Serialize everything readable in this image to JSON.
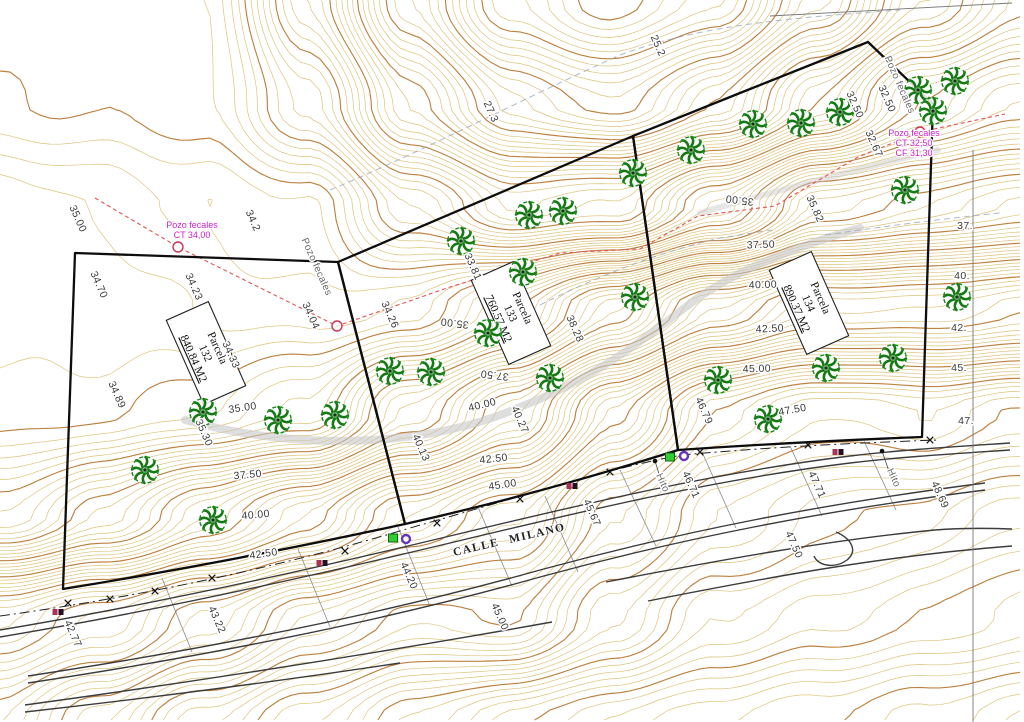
{
  "meta": {
    "width": 1024,
    "height": 722,
    "background": "#ffffff",
    "drawing_type": "topographic parcel plan"
  },
  "colors": {
    "contour": "#d9bc6d",
    "contour_index": "#b97a35",
    "parcel_line": "#0d0d0d",
    "road_line": "#3c3c3c",
    "minor_line": "#8a8a8a",
    "tree_green": "#157a15",
    "tree_ring": "#1d8a1d",
    "magenta": "#cc22cc",
    "sewer_red": "#e05555",
    "drain_gray": "#9aa7bb",
    "track_gray": "#c8c8c8",
    "marker_green": "#33cc33",
    "marker_purple": "#6633bb",
    "marker_red": "#aa3355"
  },
  "street": {
    "label": "CALLE MILANO",
    "x": 510,
    "y": 543,
    "rot": -13
  },
  "parcels": [
    {
      "title": "Parcela",
      "number": "132",
      "area": "840.84 M2",
      "x": 206,
      "y": 353,
      "rot": 66,
      "outline": "M 75,253 L 338,262 L 405,524 Q 230,562 63,589 Z"
    },
    {
      "title": "Parcela",
      "number": "133",
      "area": "760.57 M2",
      "x": 511,
      "y": 313,
      "rot": 66,
      "outline": "M 338,262 L 633,136 L 678,450 Q 535,495 405,524 Z"
    },
    {
      "title": "Parcela",
      "number": "134",
      "area": "890.37 M2",
      "x": 809,
      "y": 303,
      "rot": 66,
      "outline": "M 633,136 L 740,93 L 868,42 L 933,104 L 922,437 Q 795,442 678,450 Z"
    }
  ],
  "labels": [
    {
      "t": "35.00",
      "x": 75,
      "y": 220,
      "r": 66
    },
    {
      "t": "34.2",
      "x": 250,
      "y": 222,
      "r": 66
    },
    {
      "t": "34.70",
      "x": 96,
      "y": 286,
      "r": 66
    },
    {
      "t": "34.23",
      "x": 191,
      "y": 288,
      "r": 66
    },
    {
      "t": "34.04",
      "x": 308,
      "y": 317,
      "r": 66
    },
    {
      "t": "34.26",
      "x": 387,
      "y": 316,
      "r": 66
    },
    {
      "t": "34.33",
      "x": 228,
      "y": 356,
      "r": 66
    },
    {
      "t": "34.89",
      "x": 114,
      "y": 396,
      "r": 66
    },
    {
      "t": "35.30",
      "x": 201,
      "y": 434,
      "r": 66
    },
    {
      "t": "33.81",
      "x": 470,
      "y": 268,
      "r": 66
    },
    {
      "t": "38.28",
      "x": 572,
      "y": 330,
      "r": 66
    },
    {
      "t": "35.82",
      "x": 812,
      "y": 210,
      "r": 66
    },
    {
      "t": "32.50",
      "x": 852,
      "y": 106,
      "r": 66
    },
    {
      "t": "32.50",
      "x": 884,
      "y": 100,
      "r": 66
    },
    {
      "t": "32.67",
      "x": 871,
      "y": 145,
      "r": 66
    },
    {
      "t": "25.2",
      "x": 655,
      "y": 47,
      "r": 66
    },
    {
      "t": "27.3",
      "x": 488,
      "y": 113,
      "r": 66
    },
    {
      "t": "40.13",
      "x": 418,
      "y": 449,
      "r": 66
    },
    {
      "t": "40.27",
      "x": 517,
      "y": 421,
      "r": 66
    },
    {
      "t": "42.77",
      "x": 70,
      "y": 635,
      "r": 66
    },
    {
      "t": "43.22",
      "x": 214,
      "y": 621,
      "r": 66
    },
    {
      "t": "44.20",
      "x": 406,
      "y": 577,
      "r": 66
    },
    {
      "t": "45.67",
      "x": 589,
      "y": 514,
      "r": 66
    },
    {
      "t": "45.00",
      "x": 497,
      "y": 618,
      "r": 66
    },
    {
      "t": "46.79",
      "x": 701,
      "y": 412,
      "r": 66
    },
    {
      "t": "46.71",
      "x": 688,
      "y": 486,
      "r": 66
    },
    {
      "t": "47.71",
      "x": 814,
      "y": 486,
      "r": 66
    },
    {
      "t": "47.50",
      "x": 791,
      "y": 546,
      "r": 66
    },
    {
      "t": "48.69",
      "x": 937,
      "y": 496,
      "r": 66
    },
    {
      "t": "35.00",
      "x": 243,
      "y": 411,
      "r": -8
    },
    {
      "t": "37.50",
      "x": 248,
      "y": 478,
      "r": -5
    },
    {
      "t": "40.00",
      "x": 256,
      "y": 518,
      "r": -5
    },
    {
      "t": "42.50",
      "x": 264,
      "y": 557,
      "r": -8
    },
    {
      "t": "35.00",
      "x": 455,
      "y": 320,
      "r": 187
    },
    {
      "t": "37.50",
      "x": 495,
      "y": 372,
      "r": 187
    },
    {
      "t": "35.00",
      "x": 740,
      "y": 197,
      "r": 187
    },
    {
      "t": "40.00",
      "x": 483,
      "y": 408,
      "r": -14
    },
    {
      "t": "42.50",
      "x": 494,
      "y": 462,
      "r": -6
    },
    {
      "t": "45.00",
      "x": 503,
      "y": 488,
      "r": -8
    },
    {
      "t": "37.50",
      "x": 761,
      "y": 248,
      "r": -2
    },
    {
      "t": "40.00",
      "x": 763,
      "y": 288,
      "r": -2
    },
    {
      "t": "42.50",
      "x": 770,
      "y": 332,
      "r": -3
    },
    {
      "t": "45.00",
      "x": 757,
      "y": 372,
      "r": -2
    },
    {
      "t": "47.50",
      "x": 793,
      "y": 413,
      "r": -10
    },
    {
      "t": "37.",
      "x": 965,
      "y": 229,
      "r": 0
    },
    {
      "t": "40.",
      "x": 962,
      "y": 279,
      "r": 0
    },
    {
      "t": "42.",
      "x": 959,
      "y": 331,
      "r": 0
    },
    {
      "t": "45.",
      "x": 959,
      "y": 371,
      "r": 0
    },
    {
      "t": "47.",
      "x": 966,
      "y": 424,
      "r": 0
    },
    {
      "t": "Pozo fecales",
      "x": 314,
      "y": 268,
      "r": 66,
      "c": "gray"
    },
    {
      "t": "Pozo fecales",
      "x": 897,
      "y": 86,
      "r": 66,
      "c": "gray"
    },
    {
      "t": "Hito",
      "x": 660,
      "y": 484,
      "r": 66,
      "c": "gray"
    },
    {
      "t": "Hito",
      "x": 891,
      "y": 479,
      "r": 66,
      "c": "gray"
    }
  ],
  "wells": {
    "notes": [
      {
        "lines": [
          "Pozo fecales",
          "CT 34,00"
        ],
        "x": 192,
        "y": 228
      },
      {
        "lines": [
          "Pozo fecales",
          "CT 32,50",
          "CF 31,30"
        ],
        "x": 914,
        "y": 136
      }
    ],
    "shafts": [
      [
        178,
        247
      ],
      [
        337,
        326
      ],
      [
        920,
        132
      ]
    ]
  },
  "trees": [
    [
      203,
      412
    ],
    [
      278,
      420
    ],
    [
      335,
      415
    ],
    [
      145,
      470
    ],
    [
      213,
      520
    ],
    [
      390,
      371
    ],
    [
      431,
      372
    ],
    [
      461,
      241
    ],
    [
      529,
      215
    ],
    [
      563,
      211
    ],
    [
      523,
      272
    ],
    [
      488,
      333
    ],
    [
      550,
      378
    ],
    [
      635,
      297
    ],
    [
      633,
      173
    ],
    [
      691,
      150
    ],
    [
      753,
      124
    ],
    [
      801,
      123
    ],
    [
      840,
      112
    ],
    [
      918,
      90
    ],
    [
      955,
      81
    ],
    [
      933,
      111
    ],
    [
      718,
      380
    ],
    [
      768,
      419
    ],
    [
      826,
      368
    ],
    [
      893,
      358
    ],
    [
      957,
      297
    ],
    [
      905,
      190
    ]
  ],
  "markers": {
    "green_squares": [
      [
        393,
        538
      ],
      [
        670,
        457
      ]
    ],
    "purple_rings": [
      [
        406,
        539
      ],
      [
        684,
        456
      ]
    ],
    "red_pairs": [
      [
        58,
        612
      ],
      [
        322,
        563
      ],
      [
        572,
        486
      ],
      [
        838,
        452
      ]
    ],
    "black_dots": [
      [
        882,
        451
      ],
      [
        655,
        461
      ]
    ],
    "leaders": [
      [
        882,
        451,
        891,
        477
      ],
      [
        655,
        461,
        660,
        477
      ]
    ]
  },
  "road": {
    "fence": "M 0,616 C 130,598 270,570 410,528 C 530,494 610,468 682,455 C 770,447 855,443 938,440",
    "fence_x": [
      [
        68,
        603
      ],
      [
        110,
        599
      ],
      [
        155,
        591
      ],
      [
        212,
        578
      ],
      [
        345,
        551
      ],
      [
        437,
        523
      ],
      [
        520,
        499
      ],
      [
        610,
        472
      ],
      [
        700,
        452
      ],
      [
        808,
        445
      ],
      [
        930,
        440
      ]
    ],
    "edges": [
      "M 0,630 C 150,605 300,572 450,536 C 600,500 720,472 850,456 C 900,450 950,447 1010,443",
      "M 0,637 C 150,612 300,579 450,543 C 600,507 720,479 850,463 C 900,457 950,454 1010,450",
      "M 28,676 C 200,650 380,615 540,570 C 680,532 820,504 985,483",
      "M 28,683 C 200,657 380,622 540,577 C 680,539 820,511 985,490",
      "M 25,705 C 200,681 390,651 552,622",
      "M 25,712 C 150,698 280,681 400,663",
      "M 606,582 C 720,560 830,540 935,530 C 960,528 985,528 1012,529",
      "M 648,601 C 760,579 880,556 1012,546",
      "M 836,532 C 852,539 858,551 847,560 C 835,569 818,566 814,556"
    ],
    "crossings": [
      [
        162,
        578,
        192,
        652
      ],
      [
        298,
        549,
        330,
        627
      ],
      [
        398,
        527,
        430,
        606
      ],
      [
        478,
        507,
        512,
        586
      ],
      [
        545,
        496,
        578,
        572
      ],
      [
        620,
        470,
        656,
        546
      ],
      [
        702,
        452,
        736,
        528
      ],
      [
        790,
        446,
        822,
        516
      ],
      [
        864,
        441,
        896,
        510
      ]
    ],
    "border_lines": [
      "M 770,16 L 1012,3",
      "M 973,150 L 973,722"
    ]
  },
  "utilities": {
    "sewer_red_dashed": [
      [
        95,
        198
      ],
      [
        178,
        247
      ],
      [
        337,
        326
      ],
      [
        450,
        287
      ],
      [
        560,
        253
      ],
      [
        640,
        249
      ],
      [
        698,
        216
      ],
      [
        775,
        206
      ],
      [
        858,
        157
      ],
      [
        920,
        132
      ],
      [
        1005,
        114
      ]
    ],
    "drain_gray_dashed": [
      "M 330,190 C 430,148 520,100 620,55 C 700,25 790,18 900,10",
      "M 540,305 C 600,275 660,252 720,238 L 772,230",
      "M 825,235 C 880,227 940,219 1000,213"
    ],
    "track_bands": [
      "M 185,420 C 300,452 430,447 520,407 C 600,377 655,330 695,300 C 735,272 790,248 860,228",
      "M 700,213 C 780,190 860,168 938,150"
    ]
  },
  "terrain": {
    "interval": 0.25,
    "index_every": 1.25,
    "cell": 10,
    "xs": [
      0,
      102,
      205,
      307,
      410,
      512,
      614,
      717,
      819,
      922,
      1024
    ],
    "ys": [
      0,
      103,
      206,
      309,
      412,
      516,
      619,
      722
    ],
    "values": [
      [
        33.6,
        33.6,
        33.5,
        30.5,
        27.0,
        24.5,
        23.5,
        24.5,
        27.0,
        29.5,
        31.0
      ],
      [
        33.7,
        33.7,
        33.6,
        32.0,
        29.0,
        26.8,
        26.0,
        27.5,
        30.0,
        32.5,
        33.5
      ],
      [
        34.8,
        34.5,
        34.2,
        34.0,
        32.0,
        30.5,
        30.8,
        33.0,
        35.8,
        36.5,
        37.2
      ],
      [
        34.6,
        34.6,
        34.4,
        34.3,
        34.6,
        36.2,
        38.5,
        40.8,
        42.0,
        42.0,
        42.4
      ],
      [
        34.8,
        34.9,
        35.3,
        35.9,
        38.3,
        40.3,
        43.5,
        46.3,
        47.3,
        47.0,
        47.5
      ],
      [
        36.5,
        37.8,
        39.5,
        41.0,
        43.0,
        44.2,
        46.5,
        48.0,
        48.6,
        48.9,
        49.5
      ],
      [
        42.0,
        42.8,
        44.0,
        45.5,
        46.5,
        46.3,
        48.0,
        49.2,
        49.6,
        50.0,
        50.4
      ],
      [
        44.0,
        45.5,
        47.0,
        48.0,
        49.0,
        49.8,
        50.5,
        51.0,
        51.3,
        51.6,
        52.0
      ]
    ]
  }
}
